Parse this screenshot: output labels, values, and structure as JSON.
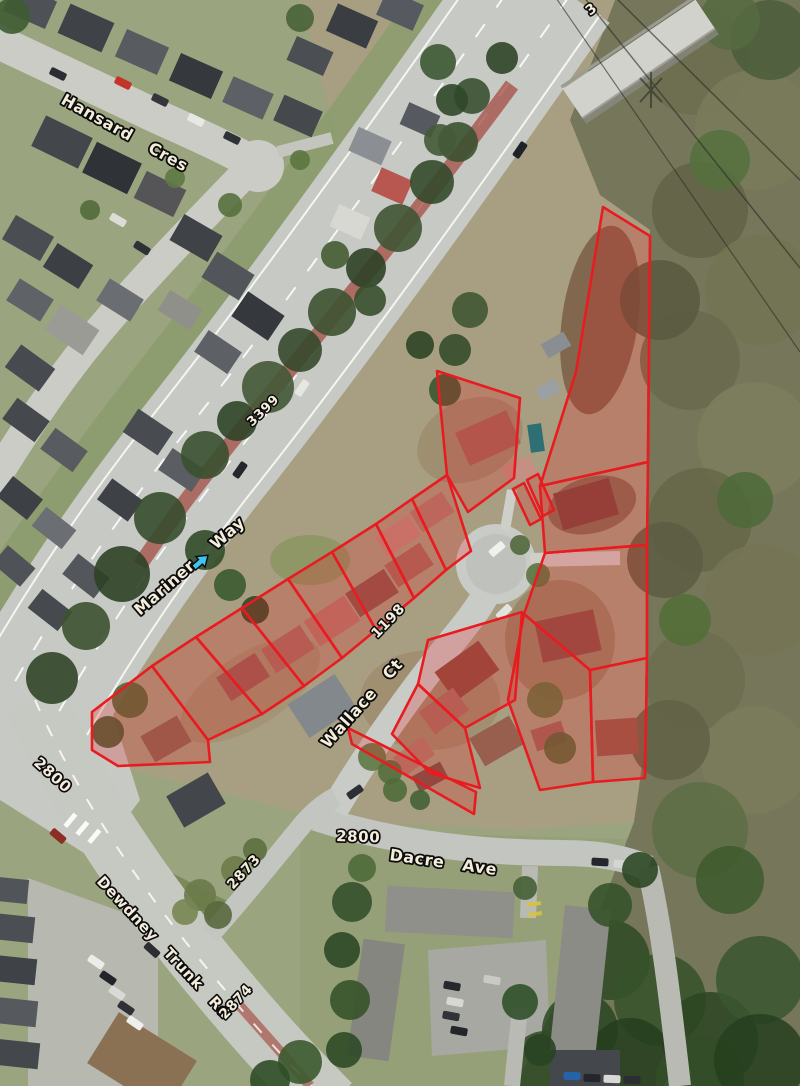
{
  "map": {
    "description": "Aerial orthophoto with highlighted property parcels around Wallace Ct cul-de-sac",
    "colors": {
      "parcel_stroke": "#e81c20",
      "parcel_fill": "rgba(232,30,30,0.24)",
      "label_fill": "#f4eddc",
      "label_halo": "#0c0c0c",
      "arrow_color": "#3fc3f2"
    },
    "labels": [
      {
        "id": "hansard-cres",
        "text": "Hansard Cres",
        "x": 60,
        "y": 103,
        "rot": 29,
        "size": 16,
        "ws": 14
      },
      {
        "id": "route-3399",
        "text": "3399",
        "x": 252,
        "y": 427,
        "rot": -44,
        "size": 13,
        "ws": 8
      },
      {
        "id": "route-3-partial",
        "text": "3",
        "x": 590,
        "y": 16,
        "rot": -38,
        "size": 14,
        "ws": 8
      },
      {
        "id": "mariner",
        "text": "Mariner",
        "x": 140,
        "y": 616,
        "rot": -41,
        "size": 16,
        "ws": 8
      },
      {
        "id": "way",
        "text": "Way",
        "x": 216,
        "y": 550,
        "rot": -41,
        "size": 16,
        "ws": 8
      },
      {
        "id": "addr-1198",
        "text": "1198",
        "x": 377,
        "y": 639,
        "rot": -46,
        "size": 14,
        "ws": 8
      },
      {
        "id": "wallace-ct",
        "text": "Wallace Ct",
        "x": 328,
        "y": 749,
        "rot": -48,
        "size": 16,
        "ws": 12
      },
      {
        "id": "addr-2800-dacre",
        "text": "2800",
        "x": 336,
        "y": 841,
        "rot": 2,
        "size": 15,
        "ws": 8
      },
      {
        "id": "dacre-ave",
        "text": "Dacre Ave",
        "x": 389,
        "y": 860,
        "rot": 8,
        "size": 16,
        "ws": 12
      },
      {
        "id": "addr-2800-mariner",
        "text": "2800",
        "x": 33,
        "y": 764,
        "rot": 42,
        "size": 15,
        "ws": 8
      },
      {
        "id": "dewdney-trunk-rd",
        "text": "Dewdney Trunk Rd",
        "x": 96,
        "y": 882,
        "rot": 47,
        "size": 15,
        "ws": 10
      },
      {
        "id": "addr-2873",
        "text": "2873",
        "x": 233,
        "y": 890,
        "rot": -47,
        "size": 14,
        "ws": 8
      },
      {
        "id": "addr-2874",
        "text": "2874",
        "x": 225,
        "y": 1020,
        "rot": -47,
        "size": 14,
        "ws": 8
      }
    ],
    "direction_arrow": {
      "id": "mariner-way-arrow",
      "x": 193,
      "y": 567,
      "rot": -41,
      "color": "#3fc3f2"
    },
    "parcels": [
      {
        "id": "p01",
        "points": "92,712 152,666 208,740 210,762 118,766 92,750"
      },
      {
        "id": "p02",
        "points": "152,666 196,637 262,714 208,740"
      },
      {
        "id": "p03",
        "points": "196,637 242,608 304,686 262,714"
      },
      {
        "id": "p04",
        "points": "242,608 288,579 342,658 304,686"
      },
      {
        "id": "p05",
        "points": "288,579 332,552 376,630 342,658"
      },
      {
        "id": "p06",
        "points": "332,552 376,524 414,598 376,630"
      },
      {
        "id": "p07",
        "points": "376,524 412,499 446,570 414,598"
      },
      {
        "id": "p08",
        "points": "412,499 447,475 471,551 446,570"
      },
      {
        "id": "p09",
        "points": "437,371 520,398 514,478 468,512 447,475"
      },
      {
        "id": "p10",
        "points": "603,207 650,236 648,462 540,486 576,372"
      },
      {
        "id": "p11",
        "points": "540,486 648,462 647,545 545,553"
      },
      {
        "id": "p12",
        "points": "545,553 647,545 647,658 590,670 524,614"
      },
      {
        "id": "p13",
        "points": "590,670 647,658 645,778 593,782"
      },
      {
        "id": "p14",
        "points": "524,614 590,670 593,782 540,790 508,700"
      },
      {
        "id": "p15",
        "points": "428,640 522,612 515,700 465,728 418,684"
      },
      {
        "id": "p16",
        "points": "418,684 465,728 480,788 430,773 392,734"
      },
      {
        "id": "p17",
        "points": "348,728 476,792 474,814 352,744"
      },
      {
        "id": "p18",
        "points": "513,489 524,483 541,519 530,525"
      },
      {
        "id": "p19",
        "points": "527,480 538,474 554,510 543,516"
      }
    ]
  }
}
